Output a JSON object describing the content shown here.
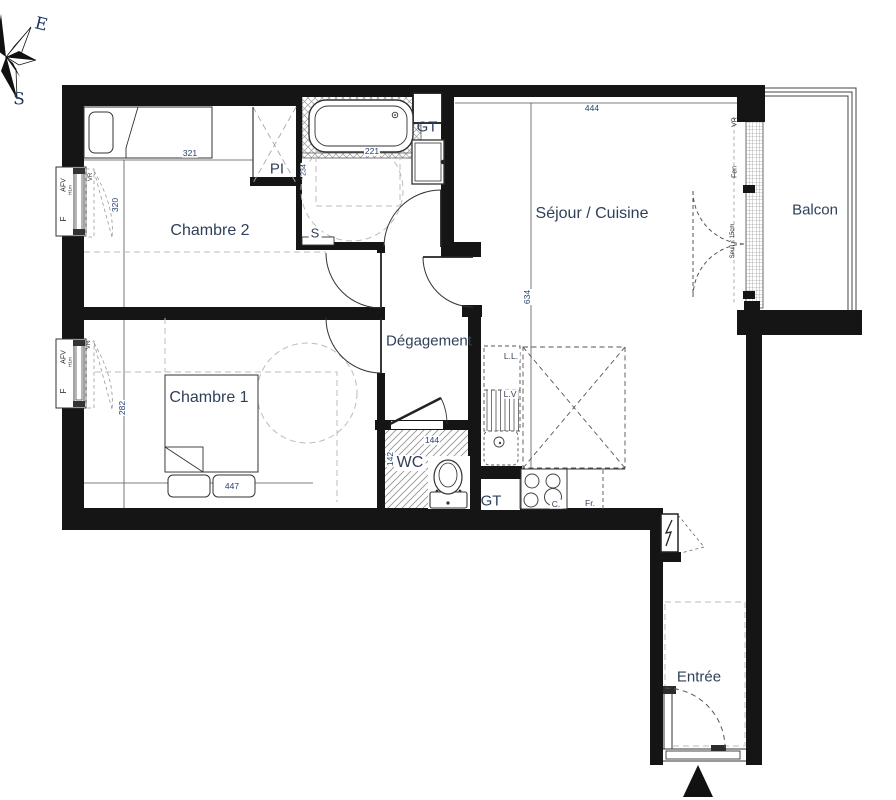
{
  "compass": {
    "east": "E",
    "south": "S"
  },
  "labels": {
    "chambre2": "Chambre 2",
    "chambre1": "Chambre 1",
    "sejour": "Séjour / Cuisine",
    "degagement": "Dégagement",
    "wc": "WC",
    "balcon": "Balcon",
    "entree": "Entrée",
    "closet": "PI",
    "sink_bath": "S",
    "duct_bath": "GT",
    "duct_kitchen": "GT",
    "washer": "L.L.",
    "dishwasher": "L.V",
    "cooktop": "C.",
    "fridge": "Fr."
  },
  "dims": {
    "ch2_w": "321",
    "ch2_h": "320",
    "bath_w": "221",
    "bath_h": "234",
    "sejour_w": "444",
    "sejour_h": "634",
    "ch1_w": "447",
    "ch1_h": "282",
    "wc_w": "144",
    "wc_h": "142"
  },
  "windows": {
    "ch2": {
      "type": "AFV",
      "height": "H1m",
      "fixed": "F",
      "shutter": "VR"
    },
    "ch1": {
      "type": "AFV",
      "height": "H1m",
      "fixed": "F",
      "shutter": "VR"
    },
    "balcony": {
      "shutter": "VR",
      "window": "Fen",
      "threshold": "Seuil < 15cm"
    }
  },
  "colors": {
    "wall": "#151515",
    "label": "#30405a",
    "dimension": "#27406e",
    "guide_dash": "#bcbcbc",
    "hatch": "#969696"
  }
}
